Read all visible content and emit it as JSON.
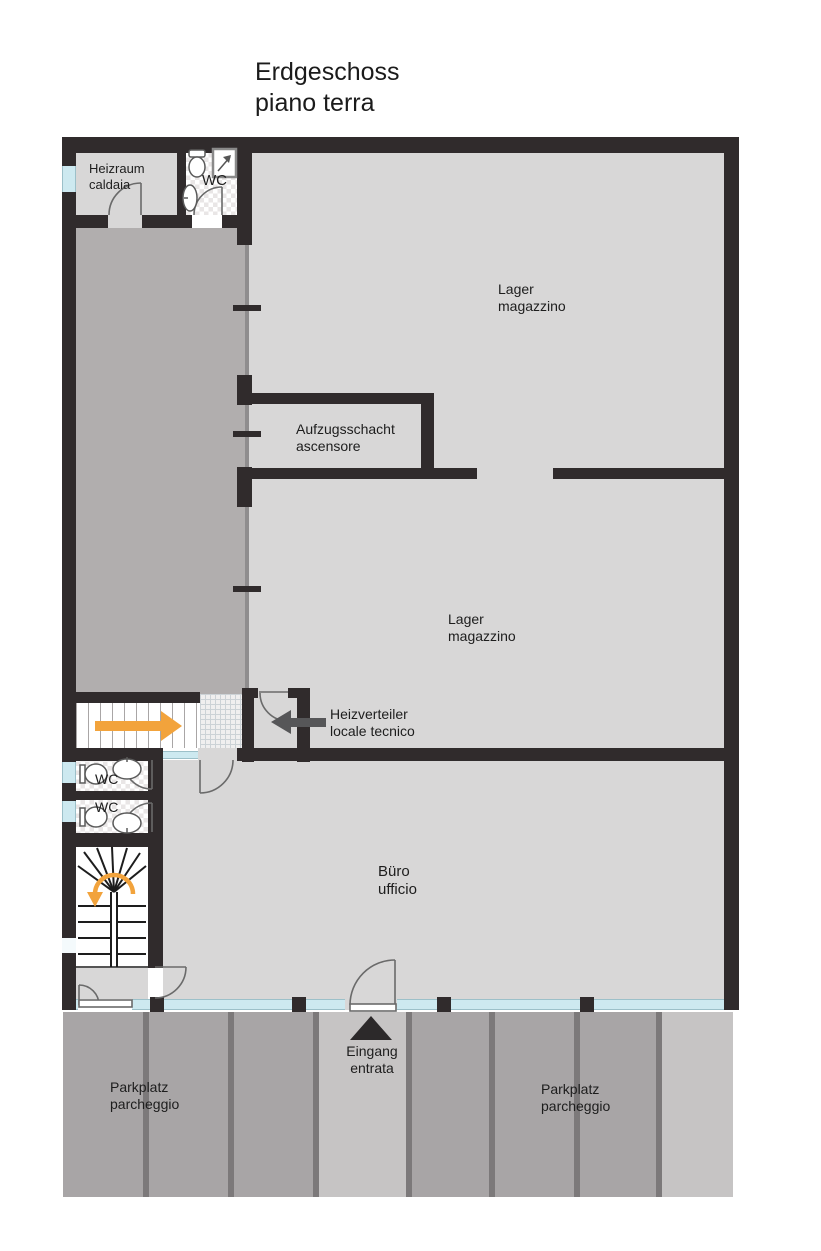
{
  "title": {
    "line1": "Erdgeschoss",
    "line2": "piano terra"
  },
  "labels": {
    "heizraum": {
      "line1": "Heizraum",
      "line2": "caldaia"
    },
    "wc_top": "WC",
    "lager_upper": {
      "line1": "Lager",
      "line2": "magazzino"
    },
    "aufzugsschacht": {
      "line1": "Aufzugsschacht",
      "line2": "ascensore"
    },
    "lager_lower": {
      "line1": "Lager",
      "line2": "magazzino"
    },
    "heizverteiler": {
      "line1": "Heizverteiler",
      "line2": "locale tecnico"
    },
    "wc_mid_upper": "WC",
    "wc_mid_lower": "WC",
    "buero": {
      "line1": "Büro",
      "line2": "ufficio"
    },
    "eingang": {
      "line1": "Eingang",
      "line2": "entrata"
    },
    "parkplatz_left": {
      "line1": "Parkplatz",
      "line2": "parcheggio"
    },
    "parkplatz_right": {
      "line1": "Parkplatz",
      "line2": "parcheggio"
    }
  },
  "colors": {
    "wall": "#302b2c",
    "room_fill": "#d8d7d7",
    "circulation_fill": "#b1aeae",
    "parking_fill": "#a8a5a6",
    "parking_divider": "#7c797a",
    "walkway_fill": "#c6c4c4",
    "glass": "#cde9f0",
    "accent_orange": "#f2a33c",
    "arrow_dark": "#565658",
    "text": "#1d1d1d"
  },
  "symbols": [
    "door-swing",
    "toilet",
    "sink",
    "shower",
    "winder-stairs",
    "ramp-arrow",
    "u-turn-arrow",
    "entrance-arrow"
  ]
}
